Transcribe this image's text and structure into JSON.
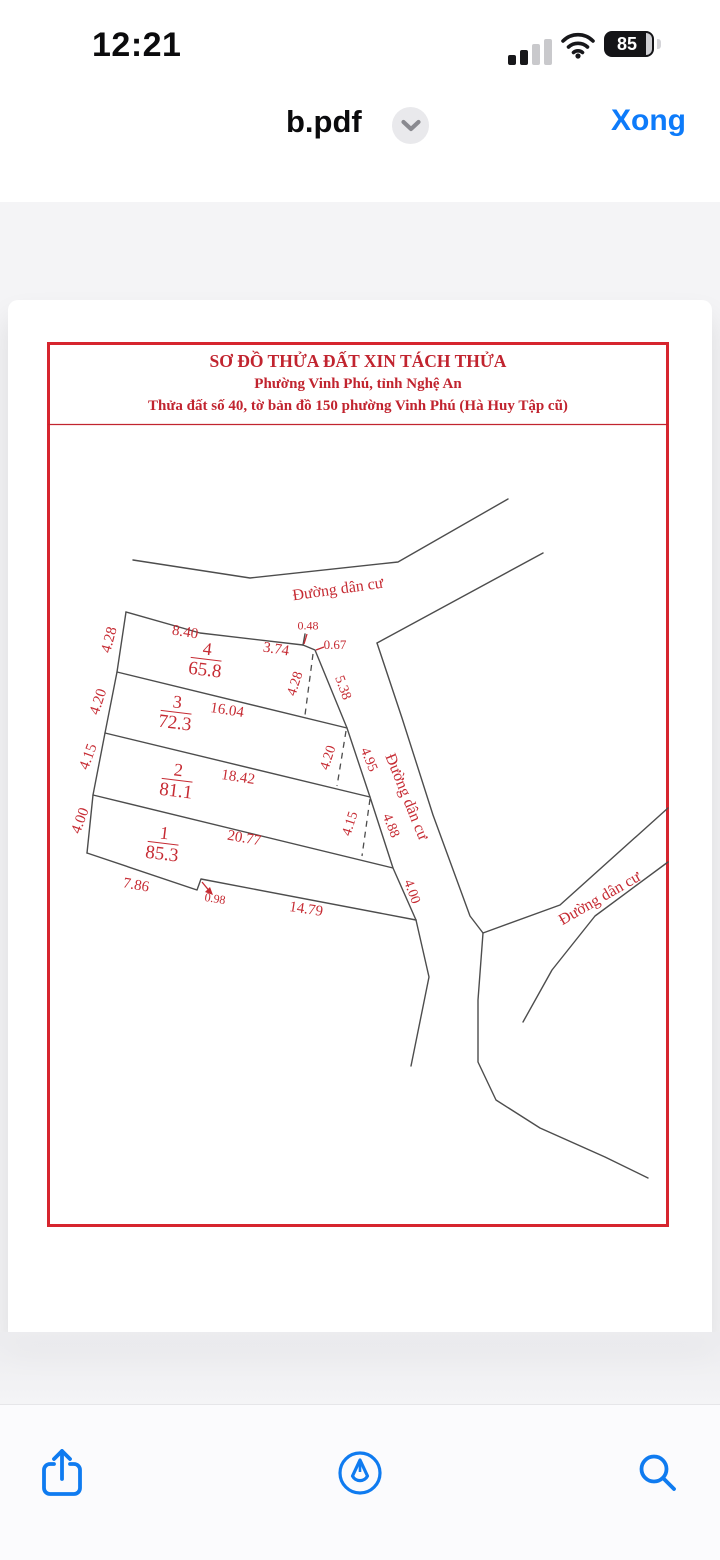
{
  "status_bar": {
    "time": "12:21",
    "battery_percent": "85"
  },
  "nav_bar": {
    "file_name": "b.pdf",
    "done_label": "Xong"
  },
  "pdf": {
    "title_lines": [
      "SƠ ĐỒ THỬA ĐẤT XIN TÁCH THỬA",
      "Phường Vinh Phú, tỉnh Nghệ An",
      "Thửa đất số 40, tờ bản đồ 150 phường Vinh Phú (Hà Huy Tập cũ)"
    ],
    "colors": {
      "label_red": "#c62b33",
      "border_red": "#d6252e",
      "line_gray": "#4d4d4d",
      "ios_blue": "#0f7bf0"
    },
    "plots": [
      {
        "number": "1",
        "area": "85.3",
        "x": 163,
        "y": 845,
        "rot": 7
      },
      {
        "number": "2",
        "area": "81.1",
        "x": 177,
        "y": 782,
        "rot": 7
      },
      {
        "number": "3",
        "area": "72.3",
        "x": 176,
        "y": 714,
        "rot": 7
      },
      {
        "number": "4",
        "area": "65.8",
        "x": 206,
        "y": 661,
        "rot": 7
      }
    ],
    "labels": [
      {
        "text": "Đường dân cư",
        "x": 338,
        "y": 590,
        "rot": -8,
        "size": 16,
        "kind": "road"
      },
      {
        "text": "Đường dân cư",
        "x": 406,
        "y": 797,
        "rot": 68,
        "size": 16,
        "kind": "road"
      },
      {
        "text": "Đường dân cư",
        "x": 600,
        "y": 899,
        "rot": -30,
        "size": 16,
        "kind": "road"
      },
      {
        "text": "4.28",
        "x": 110,
        "y": 640,
        "rot": -75,
        "size": 15,
        "kind": "dim"
      },
      {
        "text": "4.20",
        "x": 99,
        "y": 702,
        "rot": -72,
        "size": 15,
        "kind": "dim"
      },
      {
        "text": "4.15",
        "x": 89,
        "y": 757,
        "rot": -70,
        "size": 15,
        "kind": "dim"
      },
      {
        "text": "4.00",
        "x": 81,
        "y": 821,
        "rot": -70,
        "size": 15,
        "kind": "dim"
      },
      {
        "text": "8.40",
        "x": 185,
        "y": 633,
        "rot": 9,
        "size": 15,
        "kind": "dim"
      },
      {
        "text": "3.74",
        "x": 276,
        "y": 650,
        "rot": 9,
        "size": 15,
        "kind": "dim"
      },
      {
        "text": "0.48",
        "x": 308,
        "y": 626,
        "rot": 0,
        "size": 12,
        "kind": "dim"
      },
      {
        "text": "0.67",
        "x": 335,
        "y": 645,
        "rot": 0,
        "size": 13,
        "kind": "dim"
      },
      {
        "text": "4.28",
        "x": 296,
        "y": 684,
        "rot": -72,
        "size": 14,
        "kind": "dim"
      },
      {
        "text": "5.38",
        "x": 342,
        "y": 688,
        "rot": 70,
        "size": 14,
        "kind": "dim"
      },
      {
        "text": "16.04",
        "x": 227,
        "y": 711,
        "rot": 9,
        "size": 15,
        "kind": "dim"
      },
      {
        "text": "4.20",
        "x": 329,
        "y": 758,
        "rot": -72,
        "size": 14,
        "kind": "dim"
      },
      {
        "text": "4.95",
        "x": 368,
        "y": 760,
        "rot": 68,
        "size": 14,
        "kind": "dim"
      },
      {
        "text": "18.42",
        "x": 238,
        "y": 778,
        "rot": 9,
        "size": 15,
        "kind": "dim"
      },
      {
        "text": "4.15",
        "x": 351,
        "y": 824,
        "rot": -72,
        "size": 14,
        "kind": "dim"
      },
      {
        "text": "4.88",
        "x": 390,
        "y": 826,
        "rot": 68,
        "size": 14,
        "kind": "dim"
      },
      {
        "text": "20.77",
        "x": 244,
        "y": 839,
        "rot": 10,
        "size": 15,
        "kind": "dim"
      },
      {
        "text": "4.00",
        "x": 411,
        "y": 892,
        "rot": 70,
        "size": 14,
        "kind": "dim"
      },
      {
        "text": "7.86",
        "x": 136,
        "y": 886,
        "rot": 10,
        "size": 15,
        "kind": "dim"
      },
      {
        "text": "0.98",
        "x": 215,
        "y": 899,
        "rot": 9,
        "size": 12,
        "kind": "dim"
      },
      {
        "text": "14.79",
        "x": 306,
        "y": 910,
        "rot": 9,
        "size": 15,
        "kind": "dim"
      }
    ]
  },
  "toolbar": {
    "icons": [
      "share-icon",
      "markup-icon",
      "search-icon"
    ]
  }
}
